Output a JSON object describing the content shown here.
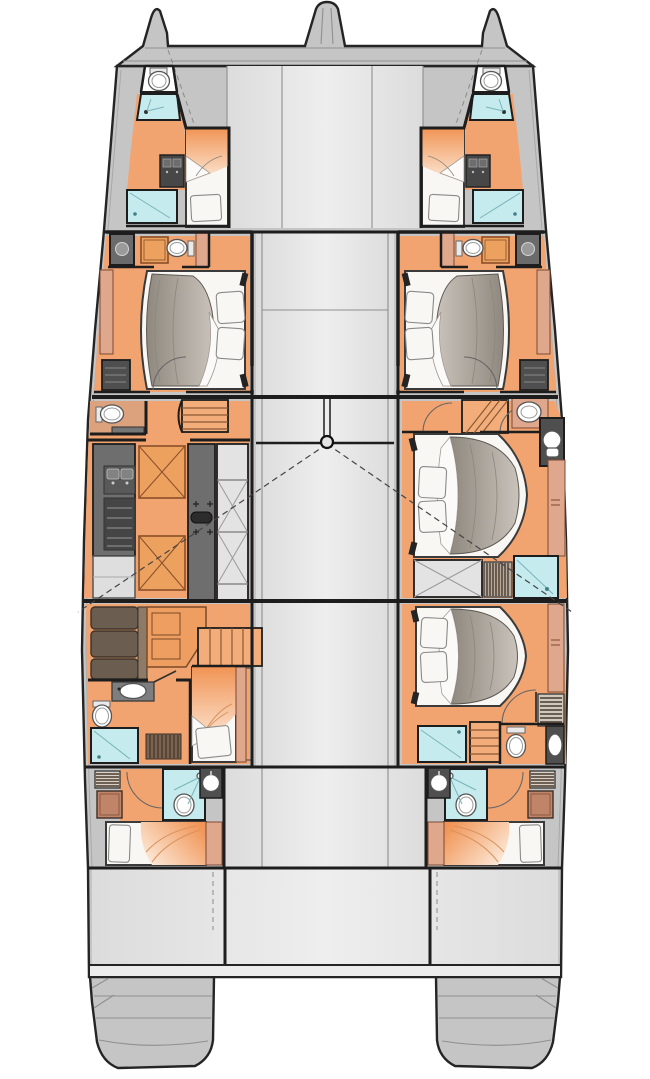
{
  "page": {
    "title": "Sailing catamaran deck floor plan"
  },
  "diagram": {
    "type": "floorplan",
    "vessel": "sailing catamaran, twin hulls, bow at top",
    "colors": {
      "hull": "#c5c5c5",
      "deck": "#e3e3e3",
      "beam": "#ececec",
      "wall": "#1d1d1d",
      "outline": "#242424",
      "seam": "#8f8f8f",
      "floor": "#f2a470",
      "floor_deep": "#eca15f",
      "stairs": "#f2ad7a",
      "peach": "#dfa78c",
      "cyan": "#c6ebee",
      "fixture": "#ffffff",
      "counter": "#6e6e6e",
      "counter_dark": "#474747",
      "cabinet": "#e3e3e3",
      "mattress": "#f8f7f4",
      "duvet_dark": "#8f887f",
      "duvet_light": "#c9c3bb",
      "blanket": "#f19455",
      "blanket_fade": "#fcebdb",
      "sofa": "#6b5d4f"
    },
    "rooms": {
      "port_bow_cabin": "forepeak cabin with toilet, sink, shower and berth (port)",
      "starboard_bow_cabin": "forepeak cabin with toilet, sink, shower and berth (starboard)",
      "port_forward_cabin": "forward guest cabin with island double bed and ensuite (port)",
      "starboard_forward_cabin": "forward guest cabin with island double bed and ensuite (starboard)",
      "port_galley": "galley with counters, sink, cooktop, storage column and WC (port midship)",
      "starboard_master_cabin": "midship cabin with double bed, shower, WC and stairs (starboard)",
      "port_aft_cabin": "aft cabin with sofa, desk, bathroom and single berth (port)",
      "starboard_aft_cabin": "aft guest cabin with double bed, shower, WC and stairs (starboard)",
      "port_crew_cabin": "aft crew cabin with berth and wet head (port)",
      "starboard_crew_cabin": "aft crew cabin with berth and wet head (starboard)"
    },
    "features": {
      "mast": "mast ring on forward beam centreline",
      "rig_lines": "dashed shroud sight-lines from mast to each hull",
      "bowsprit": "central bowsprit at top",
      "transoms": "twin stern swim steps"
    }
  }
}
